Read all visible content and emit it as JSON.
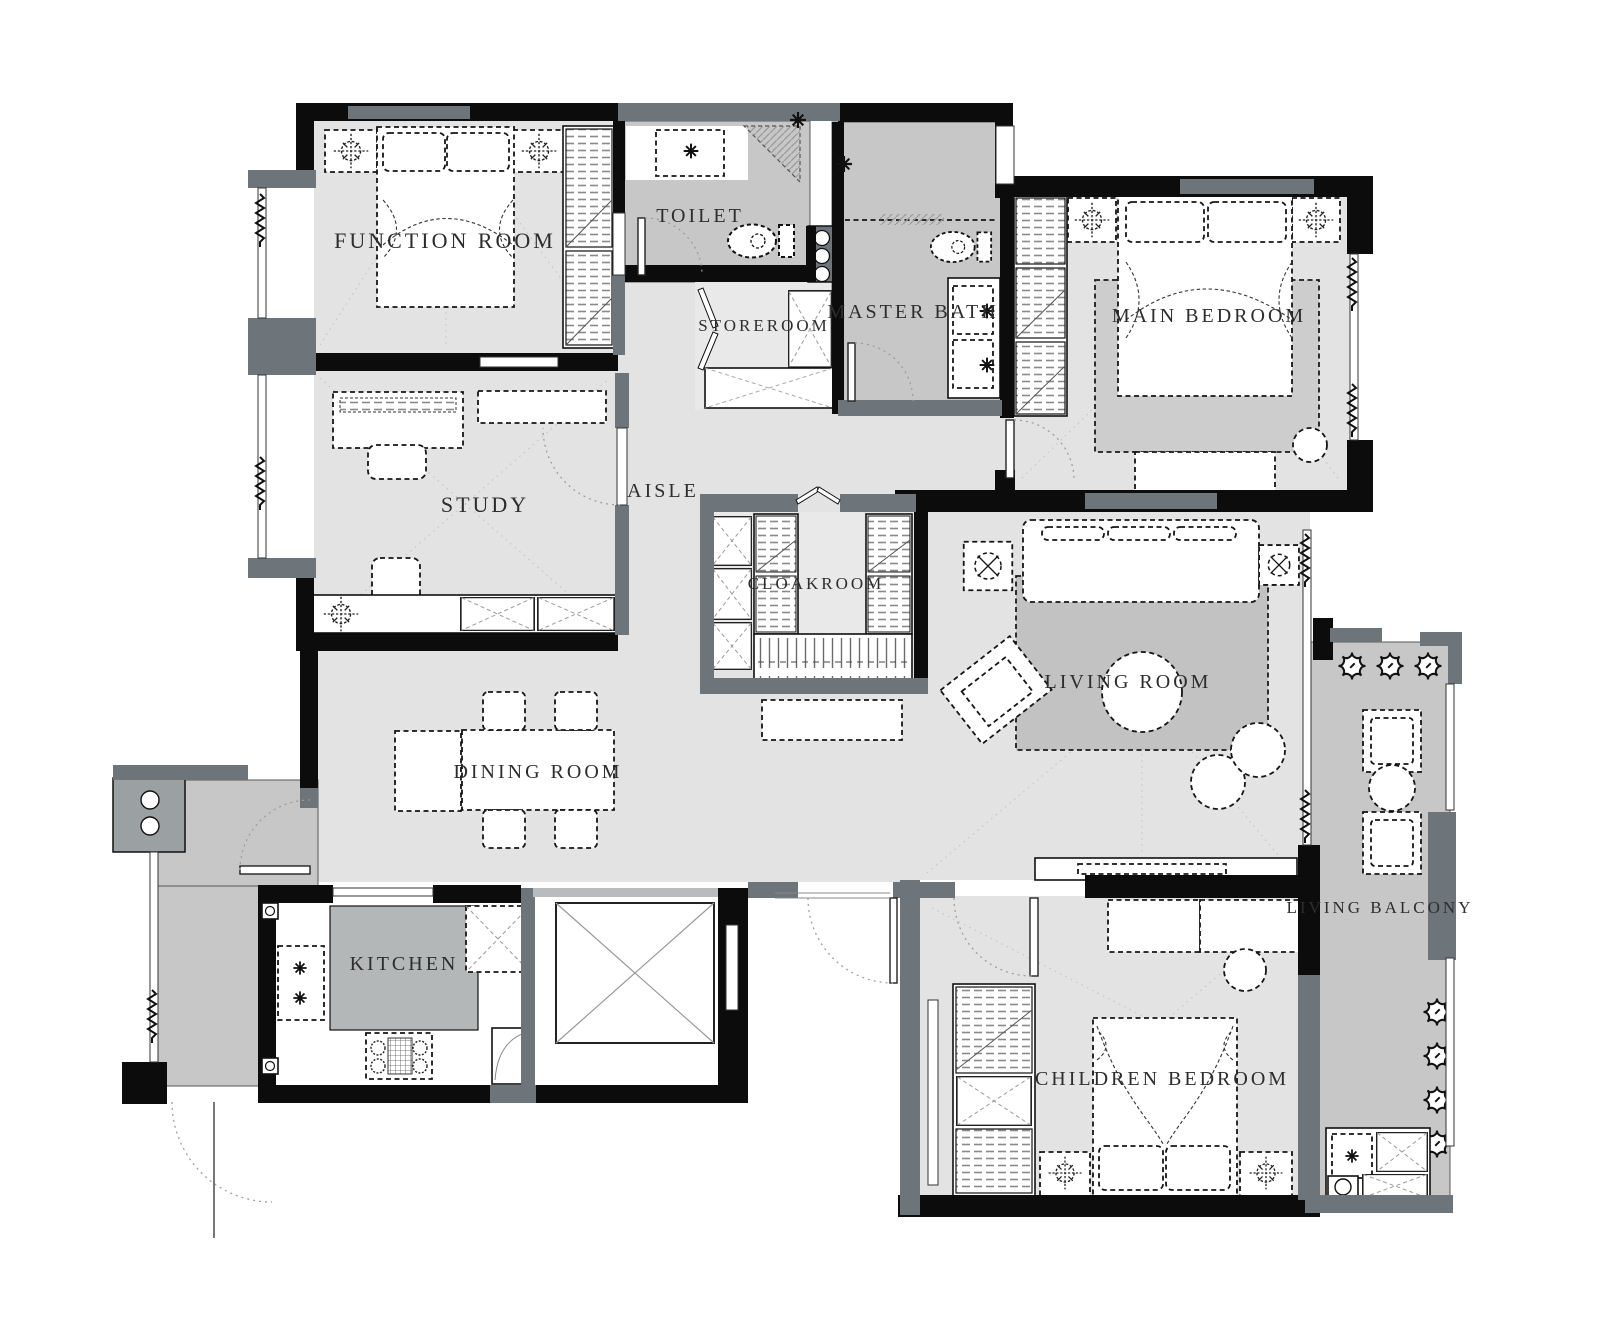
{
  "title": "Residential Apartment Floor Plan",
  "colors": {
    "wall": "#0c0c0c",
    "wall_secondary": "#6d757a",
    "floor_light": "#e3e3e3",
    "floor_mid": "#c7c7c7",
    "counter": "#b4b7b7",
    "furniture": "#ffffff",
    "line": "#151515",
    "label_text": "#2d2d2d",
    "background": "#ffffff"
  },
  "rooms": {
    "function_room": {
      "label": "FUNCTION ROOM"
    },
    "toilet": {
      "label": "TOILET"
    },
    "storeroom": {
      "label": "STOREROOM"
    },
    "master_bath": {
      "label": "MASTER BATH"
    },
    "main_bedroom": {
      "label": "MAIN BEDROOM"
    },
    "study": {
      "label": "STUDY"
    },
    "aisle": {
      "label": "AISLE"
    },
    "cloakroom": {
      "label": "CLOAKROOM"
    },
    "living_room": {
      "label": "LIVING ROOM"
    },
    "dining_room": {
      "label": "DINING ROOM"
    },
    "kitchen": {
      "label": "KITCHEN"
    },
    "children_bedroom": {
      "label": "CHILDREN BEDROOM"
    },
    "living_balcony": {
      "label": "LIVING BALCONY"
    }
  },
  "icons": {
    "ceiling_light_icon": "dashed circle with crosshair",
    "plant_icon": "scalloped circle",
    "side_table_icon": "dashed square with crossed circle",
    "toilet_icon": "bowl with cistern",
    "faucet_icon": "cross valve",
    "washing_machine_icon": "cabinet with drum circle",
    "elevator_icon": "square with X diagonals"
  }
}
